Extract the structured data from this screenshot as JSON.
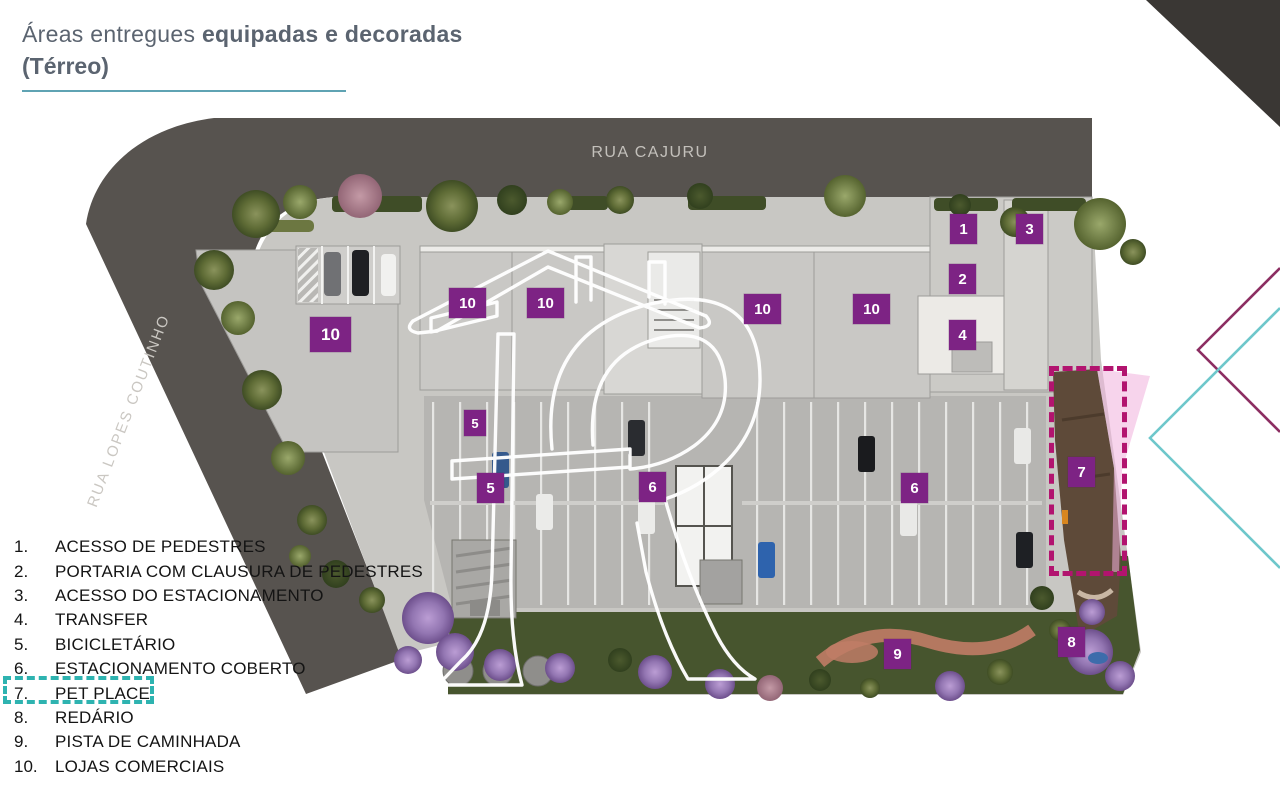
{
  "title": {
    "line1_regular": "Áreas entregues ",
    "line1_bold": "equipadas e decoradas",
    "line2_bold": "(Térreo)"
  },
  "plan": {
    "street_top": "RUA CAJURU",
    "street_left": "RUA LOPES COUTINHO"
  },
  "legend": {
    "highlighted_item": "7",
    "items": [
      {
        "num": "1.",
        "label": "ACESSO DE PEDESTRES"
      },
      {
        "num": "2.",
        "label": "PORTARIA COM CLAUSURA DE PEDESTRES"
      },
      {
        "num": "3.",
        "label": "ACESSO DO ESTACIONAMENTO"
      },
      {
        "num": "4.",
        "label": "TRANSFER"
      },
      {
        "num": "5.",
        "label": "BICICLETÁRIO"
      },
      {
        "num": "6.",
        "label": "ESTACIONAMENTO COBERTO"
      },
      {
        "num": "7.",
        "label": "PET PLACE"
      },
      {
        "num": "8.",
        "label": "REDÁRIO"
      },
      {
        "num": "9.",
        "label": "PISTA DE CAMINHADA"
      },
      {
        "num": "10.",
        "label": "LOJAS COMERCIAIS"
      }
    ]
  },
  "markers": [
    {
      "label": "1"
    },
    {
      "label": "2"
    },
    {
      "label": "3"
    },
    {
      "label": "4"
    },
    {
      "label": "5"
    },
    {
      "label": "5"
    },
    {
      "label": "6"
    },
    {
      "label": "6"
    },
    {
      "label": "7"
    },
    {
      "label": "8"
    },
    {
      "label": "9"
    },
    {
      "label": "10"
    },
    {
      "label": "10"
    },
    {
      "label": "10"
    },
    {
      "label": "10"
    },
    {
      "label": "10"
    }
  ],
  "colors": {
    "marker_purple": "#7d2384",
    "road_gray": "#57534f",
    "title_slate": "#5b6470",
    "title_underline_teal": "#5fa3b3",
    "legend_highlight_teal": "#2eb3b0",
    "pet_highlight_magenta": "#b2146f",
    "pet_overlay_pink": "#f0b0dc",
    "corner_triangle": "#3a3734",
    "chevron_purple": "#8c2e62",
    "chevron_teal": "#6ec7cb"
  }
}
